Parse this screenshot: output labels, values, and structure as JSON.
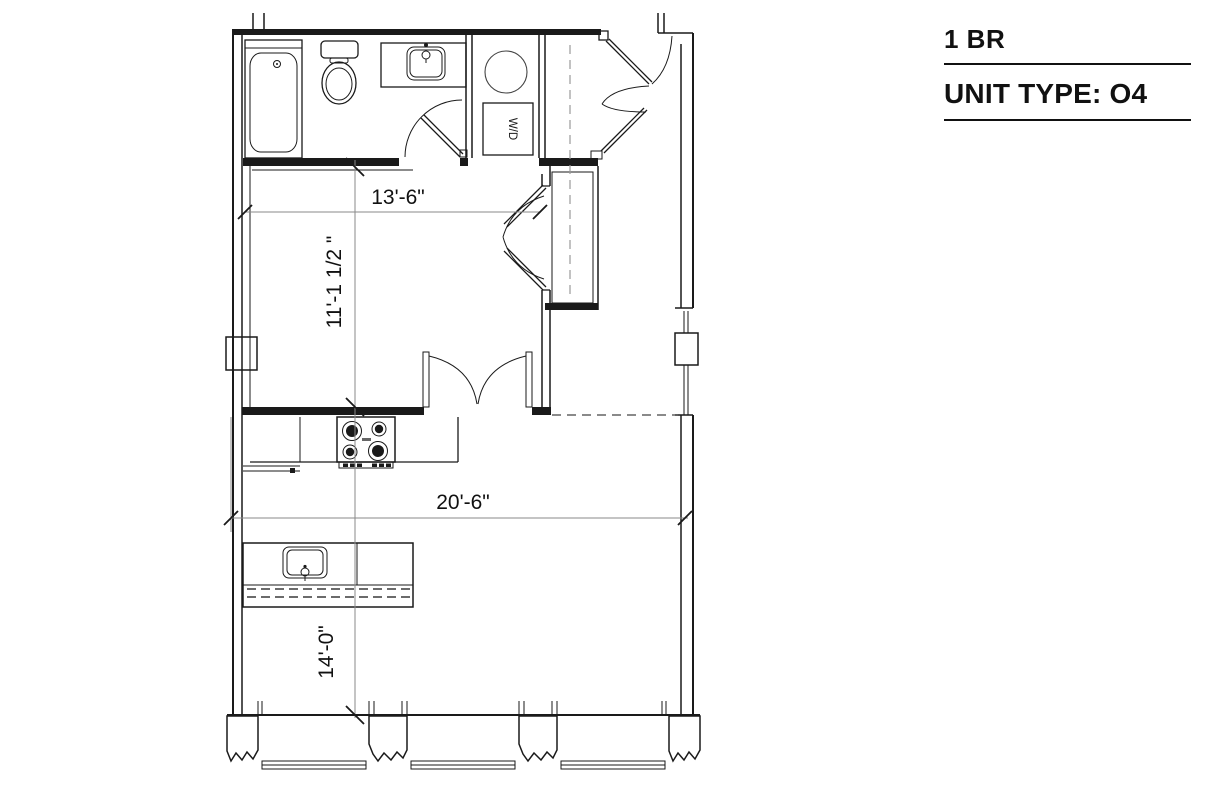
{
  "title_block": {
    "unit_size": "1 BR",
    "unit_type": "UNIT TYPE: O4"
  },
  "floor_plan": {
    "appliance_labels": {
      "washer_dryer": "W/D"
    },
    "dimensions": {
      "bedroom_width": "13'-6\"",
      "bedroom_depth": "11'-1 1/2 \"",
      "living_width": "20'-6\"",
      "living_depth": "14'-0\""
    },
    "colors": {
      "wall_line": "#1a1a1a",
      "dimension_line": "#8a8a8a",
      "dimension_text": "#111111",
      "background": "#ffffff"
    }
  }
}
